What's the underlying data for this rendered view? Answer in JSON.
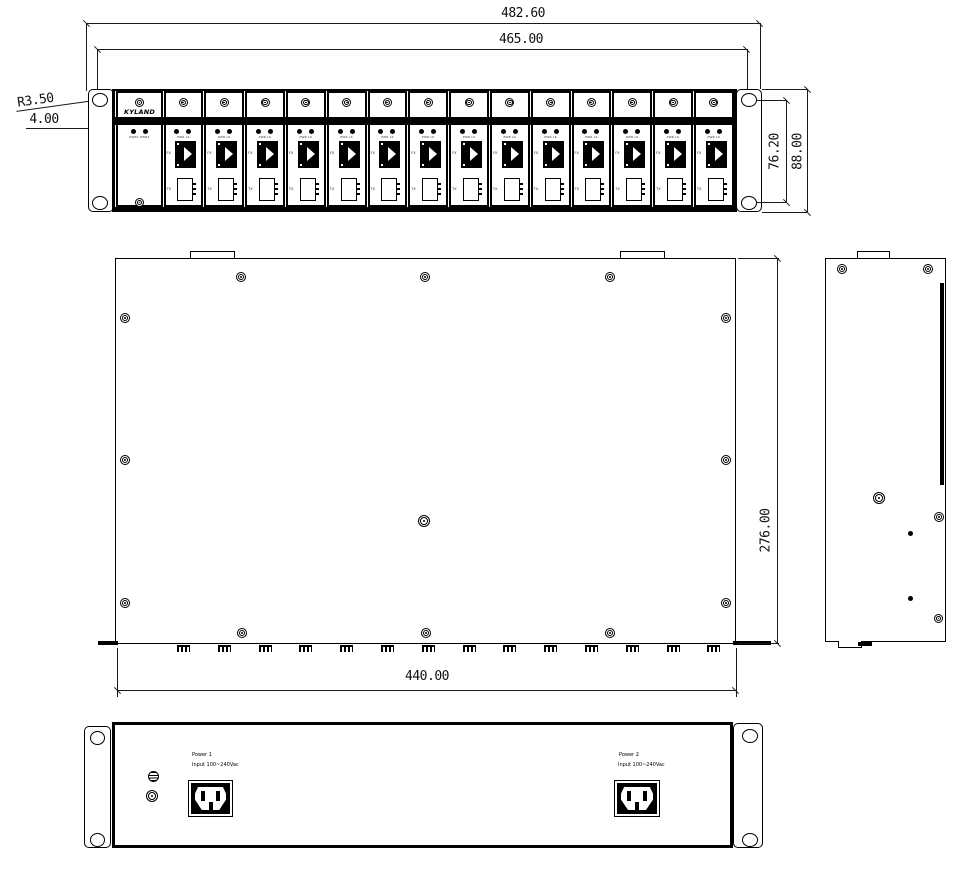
{
  "dimensions": {
    "overall_width": "482.60",
    "mounting_span": "465.00",
    "hole_radius": "R3.50",
    "slot_width": "4.00",
    "hole_vertical_span": "76.20",
    "front_height": "88.00",
    "chassis_depth": "276.00",
    "chassis_width": "440.00"
  },
  "front_view": {
    "brand_logo": "KYLAND",
    "module_count": 14,
    "power_slot": {
      "led_labels": "PWR1 PWR2"
    },
    "module": {
      "led_labels": "PWR LK",
      "fiber_port_label": "FX",
      "copper_port_label": "TX"
    }
  },
  "rear_view": {
    "power1": {
      "name": "Power 1",
      "input": "Input 100~240Vac"
    },
    "power2": {
      "name": "Power 2",
      "input": "Input 100~240Vac"
    }
  }
}
